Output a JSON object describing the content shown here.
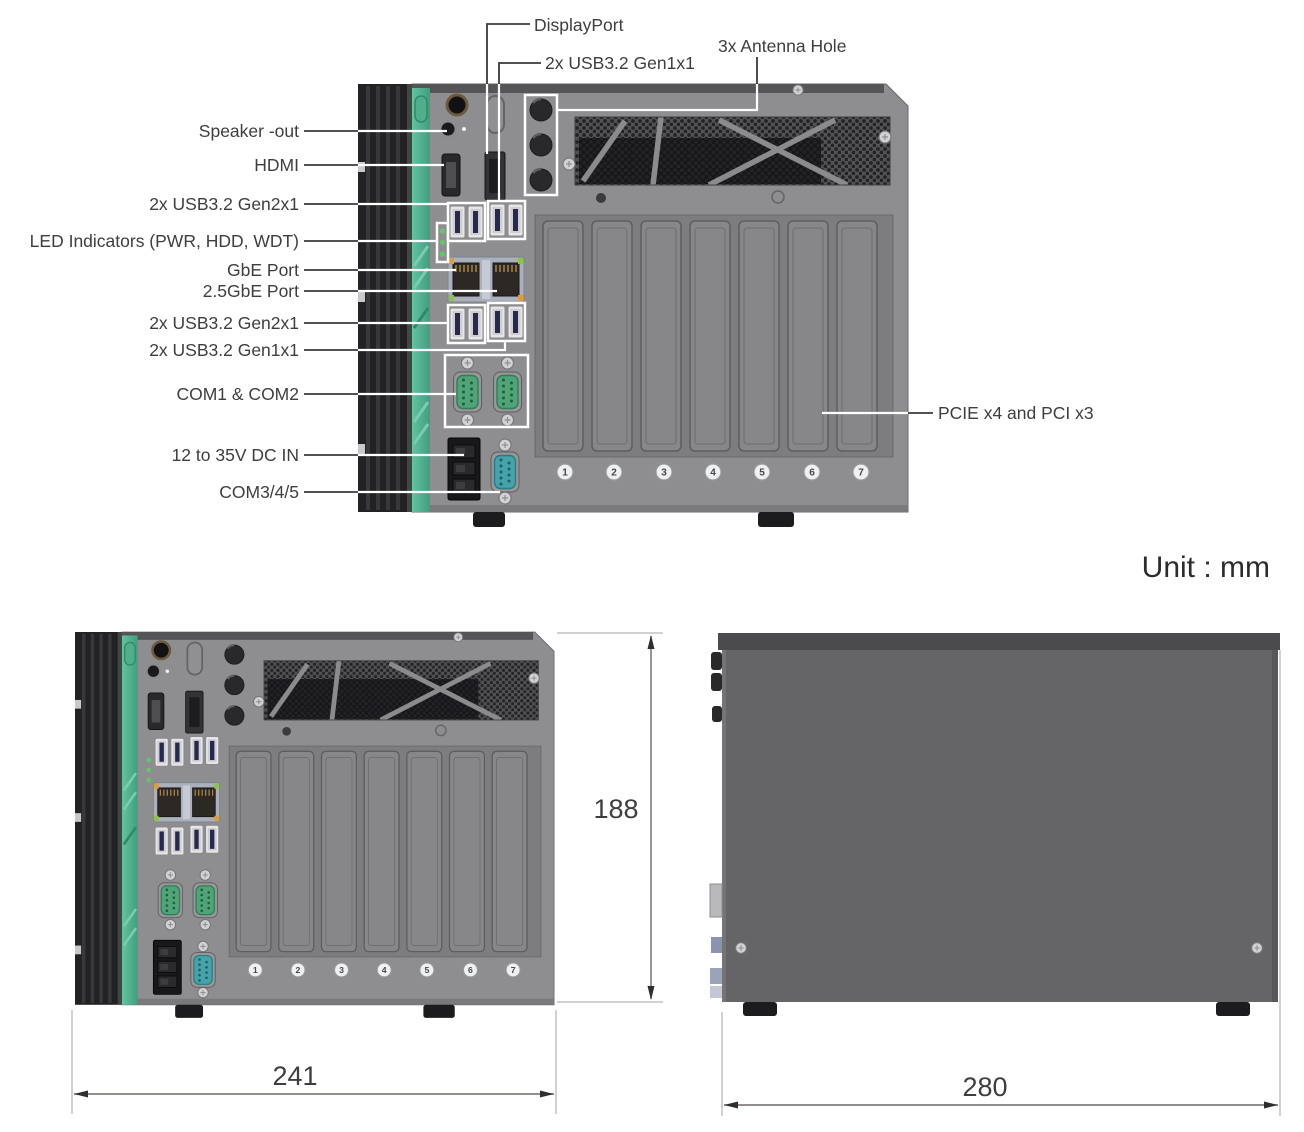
{
  "diagram": {
    "unit_label": "Unit : mm",
    "callouts": {
      "displayport": "DisplayPort",
      "usb_gen1_top": "2x USB3.2 Gen1x1",
      "antenna": "3x Antenna Hole",
      "speaker": "Speaker -out",
      "hdmi": "HDMI",
      "usb_gen2_upper": "2x USB3.2 Gen2x1",
      "led_indicators": "LED Indicators (PWR, HDD, WDT)",
      "gbe": "GbE Port",
      "gbe_25": "2.5GbE Port",
      "usb_gen2_lower": "2x USB3.2 Gen2x1",
      "usb_gen1_lower": "2x USB3.2 Gen1x1",
      "com1_com2": "COM1 & COM2",
      "dc_in": "12 to 35V  DC IN",
      "com345": "COM3/4/5",
      "pcie": "PCIE x4 and PCI x3"
    },
    "dimensions": {
      "front_width_mm": "241",
      "front_height_mm": "188",
      "side_depth_mm": "280"
    },
    "slot_screw_numbers": [
      "1",
      "2",
      "3",
      "4",
      "5",
      "6",
      "7"
    ],
    "colors": {
      "chassis_gray": "#8e8e90",
      "side_gray": "#656567",
      "rail_black": "#222224",
      "accent_teal": "#4fae8c",
      "com_port_green": "#4fa578",
      "com_port_teal": "#45a3a9",
      "usb_tab_navy": "#272750",
      "highlight_white": "#ffffff"
    }
  }
}
